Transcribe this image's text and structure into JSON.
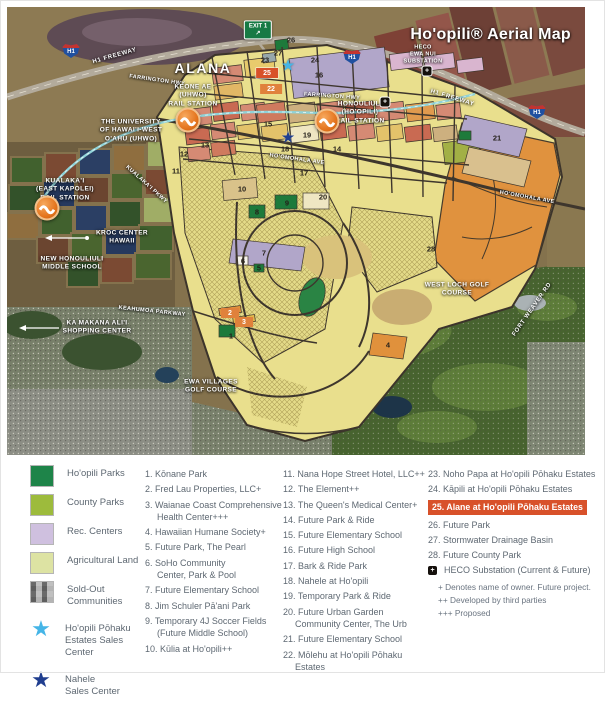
{
  "map": {
    "labels": {
      "title": "Ho'opili® Aerial Map",
      "alana": "ALANA",
      "exit_sign": "EXIT 1",
      "h1_shield": "H1",
      "h1_freeway_left": "H1 FREEWAY",
      "h1_freeway_right": "H1 FREEWAY",
      "farrington_hwy": "FARRINGTON HWY",
      "farrington_hwy_2": "FARRINGTON HWY",
      "hoomohala_ave": "HO'OMOHALA AVE",
      "hoomohala_ave_2": "HO'OMOHALA AVE",
      "kualakai_pkwy": "KUALAKA'I PKWY",
      "keahumoa_pkwy": "KEAHUMOA PARKWAY",
      "fort_weaver": "FORT WEAVER RD",
      "heco_nui": "HECO\nEWA NUI\nSUBSTATION",
      "keone_station": "KEONE AE\n(UHWO)\nRAIL STATION",
      "honouliuli_station": "HONOULIULI\n(HO'OPILI)\nRAIL STATION",
      "university": "THE UNIVERSITY\nOF HAWAI'I-WEST\nO'AHU (UHWO)",
      "kualakai_station": "KUALAKA'I\n(EAST KAPOLEI)\nRAIL STATION",
      "kroc": "KROC CENTER\nHAWAII",
      "middle_school": "NEW HONOULIULI\nMIDDLE SCHOOL",
      "ka_makana": "KA MAKANA ALI'I\nSHOPPING CENTER",
      "west_loch": "WEST LOCH GOLF\nCOURSE",
      "ewa_villages": "EWA VILLAGES\nGOLF COURSE"
    },
    "markers": [
      {
        "n": "1",
        "x": 224,
        "y": 329,
        "style": "plain"
      },
      {
        "n": "2",
        "x": 223,
        "y": 306,
        "style": "orange"
      },
      {
        "n": "3",
        "x": 237,
        "y": 315,
        "style": "orange"
      },
      {
        "n": "4",
        "x": 381,
        "y": 338,
        "style": "plain"
      },
      {
        "n": "5",
        "x": 252,
        "y": 261,
        "style": "plain"
      },
      {
        "n": "6",
        "x": 236,
        "y": 254,
        "style": "plain"
      },
      {
        "n": "7",
        "x": 257,
        "y": 246,
        "style": "plain"
      },
      {
        "n": "8",
        "x": 250,
        "y": 205,
        "style": "plain"
      },
      {
        "n": "9",
        "x": 280,
        "y": 196,
        "style": "plain"
      },
      {
        "n": "10",
        "x": 235,
        "y": 182,
        "style": "plain"
      },
      {
        "n": "11",
        "x": 169,
        "y": 164,
        "style": "plain"
      },
      {
        "n": "12",
        "x": 177,
        "y": 147,
        "style": "plain"
      },
      {
        "n": "13",
        "x": 198,
        "y": 138,
        "style": "plain"
      },
      {
        "n": "14",
        "x": 330,
        "y": 142,
        "style": "plain"
      },
      {
        "n": "15",
        "x": 261,
        "y": 117,
        "style": "plain"
      },
      {
        "n": "16",
        "x": 312,
        "y": 68,
        "style": "plain"
      },
      {
        "n": "17",
        "x": 297,
        "y": 166,
        "style": "plain"
      },
      {
        "n": "18",
        "x": 278,
        "y": 142,
        "style": "plain"
      },
      {
        "n": "19",
        "x": 300,
        "y": 128,
        "style": "plain"
      },
      {
        "n": "20",
        "x": 316,
        "y": 190,
        "style": "plain"
      },
      {
        "n": "21",
        "x": 490,
        "y": 131,
        "style": "plain"
      },
      {
        "n": "22",
        "x": 264,
        "y": 82,
        "style": "orange"
      },
      {
        "n": "23",
        "x": 258,
        "y": 53,
        "style": "plain"
      },
      {
        "n": "24",
        "x": 308,
        "y": 53,
        "style": "plain"
      },
      {
        "n": "25",
        "x": 260,
        "y": 66,
        "style": "red"
      },
      {
        "n": "26",
        "x": 284,
        "y": 33,
        "style": "plain"
      },
      {
        "n": "27",
        "x": 271,
        "y": 46,
        "style": "plain"
      },
      {
        "n": "28",
        "x": 424,
        "y": 242,
        "style": "plain"
      },
      {
        "n": "★",
        "x": 281,
        "y": 58,
        "style": "star-light"
      },
      {
        "n": "★",
        "x": 281,
        "y": 130,
        "style": "star-dark"
      },
      {
        "n": "+",
        "x": 420,
        "y": 64,
        "style": "heco"
      },
      {
        "n": "+",
        "x": 378,
        "y": 95,
        "style": "heco"
      }
    ]
  },
  "legend": {
    "swatches": [
      {
        "type": "square",
        "color": "#1e8449",
        "label": "Ho'opili Parks"
      },
      {
        "type": "square",
        "color": "#9dbb3c",
        "label": "County Parks"
      },
      {
        "type": "square",
        "color": "#cfc0df",
        "label": "Rec. Centers"
      },
      {
        "type": "square",
        "color": "#dde3a3",
        "label": "Agricultural Land"
      },
      {
        "type": "plaid",
        "color": "#9b9b9b",
        "label": "Sold-Out\nCommunities"
      },
      {
        "type": "star",
        "color": "#45b5e7",
        "label": "Ho'opili Pōhaku\nEstates Sales\nCenter"
      },
      {
        "type": "star",
        "color": "#203e8f",
        "label": "Nahele\nSales Center"
      }
    ],
    "col1": [
      "1. Kōnane Park",
      "2. Fred Lau Properties, LLC+",
      "3. Waianae Coast Comprehensive\nHealth Center+++",
      "4. Hawaiian Humane Society+",
      "5. Future Park, The Pearl",
      "6. SoHo Community\nCenter, Park & Pool",
      "7. Future Elementary School",
      "8. Jim Schuler Pā'ani Park",
      "9. Temporary 4J Soccer Fields\n(Future Middle School)",
      "10. Kūlia at Ho'opili++"
    ],
    "col2": [
      "11. Nana Hope Street Hotel, LLC++",
      "12. The Element++",
      "13. The Queen's Medical Center+",
      "14. Future Park & Ride",
      "15. Future Elementary School",
      "16. Future High School",
      "17. Bark & Ride Park",
      "18. Nahele at Ho'opili",
      "19. Temporary Park & Ride",
      "20. Future Urban Garden\nCommunity Center, The Urb",
      "21. Future Elementary School",
      "22. Mōlehu at Ho'opili Pōhaku Estates"
    ],
    "col3a": [
      "23. Noho Papa at Ho'opili Pōhaku Estates",
      "24. Kāpili at Ho'opili Pōhaku Estates"
    ],
    "highlight": "25. Alane at Ho'opili Pōhaku Estates",
    "col3b": [
      "26. Future Park",
      "27. Stormwater Drainage Basin",
      "28. Future County Park"
    ],
    "heco_icon": "+",
    "heco_label": "HECO Substation (Current & Future)",
    "footnotes": [
      "+ Denotes name of owner. Future project.",
      "++ Developed by third parties",
      "+++ Proposed"
    ],
    "highlight_color": "#d8512a"
  }
}
